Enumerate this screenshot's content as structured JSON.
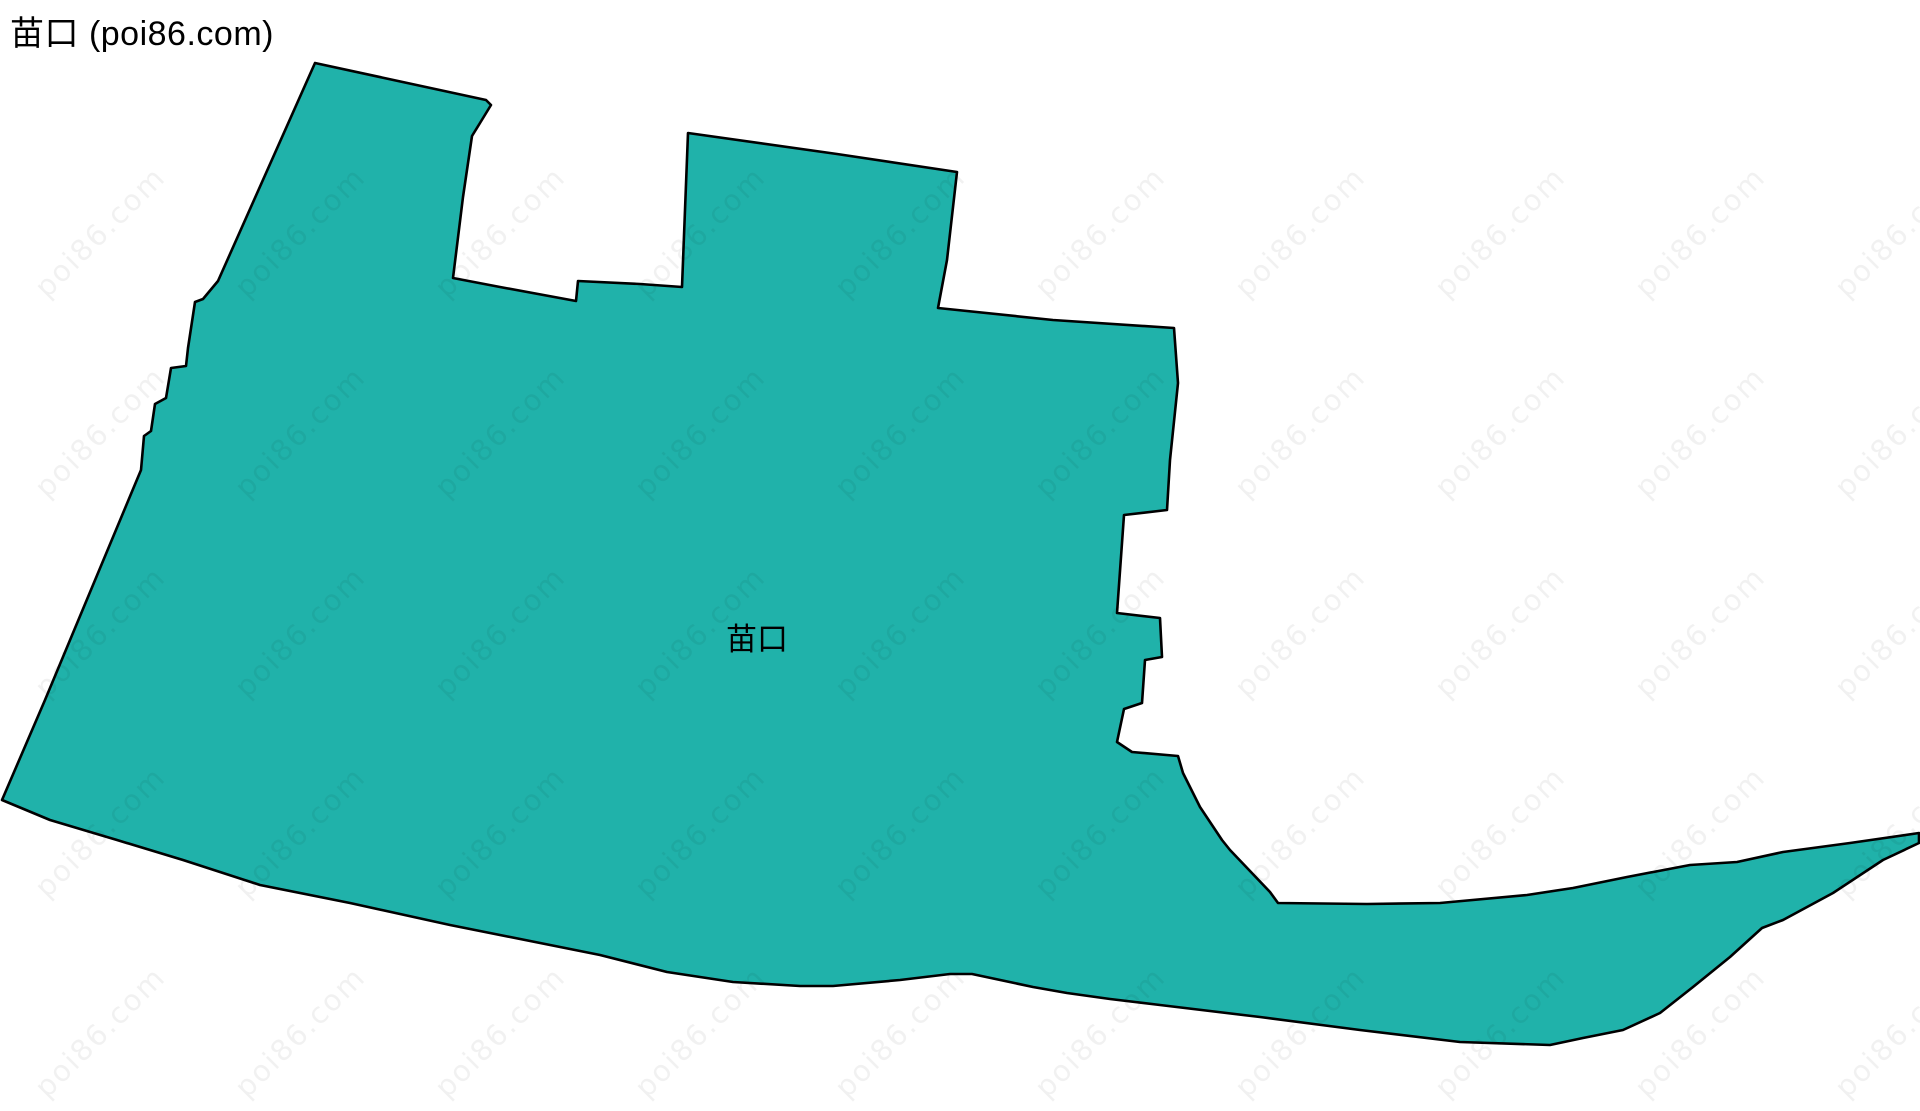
{
  "header": {
    "title": "苗口 (poi86.com)"
  },
  "map": {
    "region_name": "苗口",
    "label": "苗口",
    "label_position": {
      "x": 757,
      "y": 650
    },
    "viewbox": "0 0 1920 1111",
    "polygon_points": [
      [
        315,
        63
      ],
      [
        486,
        100
      ],
      [
        491,
        105
      ],
      [
        480,
        123
      ],
      [
        472,
        136
      ],
      [
        463,
        197
      ],
      [
        453,
        278
      ],
      [
        500,
        287
      ],
      [
        576,
        301
      ],
      [
        578,
        281
      ],
      [
        640,
        284
      ],
      [
        682,
        287
      ],
      [
        688,
        133
      ],
      [
        837,
        154
      ],
      [
        957,
        172
      ],
      [
        947,
        260
      ],
      [
        938,
        308
      ],
      [
        1053,
        320
      ],
      [
        1174,
        328
      ],
      [
        1178,
        383
      ],
      [
        1170,
        460
      ],
      [
        1167,
        510
      ],
      [
        1124,
        515
      ],
      [
        1117,
        613
      ],
      [
        1160,
        618
      ],
      [
        1162,
        657
      ],
      [
        1145,
        660
      ],
      [
        1142,
        703
      ],
      [
        1124,
        709
      ],
      [
        1117,
        742
      ],
      [
        1132,
        752
      ],
      [
        1178,
        756
      ],
      [
        1183,
        773
      ],
      [
        1200,
        807
      ],
      [
        1222,
        840
      ],
      [
        1230,
        850
      ],
      [
        1270,
        892
      ],
      [
        1278,
        903
      ],
      [
        1367,
        904
      ],
      [
        1440,
        903
      ],
      [
        1527,
        895
      ],
      [
        1573,
        888
      ],
      [
        1627,
        877
      ],
      [
        1690,
        865
      ],
      [
        1737,
        862
      ],
      [
        1783,
        852
      ],
      [
        1850,
        843
      ],
      [
        1919,
        833
      ],
      [
        1919,
        843
      ],
      [
        1883,
        860
      ],
      [
        1833,
        893
      ],
      [
        1783,
        920
      ],
      [
        1762,
        928
      ],
      [
        1730,
        957
      ],
      [
        1693,
        987
      ],
      [
        1660,
        1013
      ],
      [
        1623,
        1030
      ],
      [
        1583,
        1038
      ],
      [
        1550,
        1045
      ],
      [
        1460,
        1042
      ],
      [
        1360,
        1030
      ],
      [
        1260,
        1017
      ],
      [
        1160,
        1005
      ],
      [
        1110,
        999
      ],
      [
        1067,
        993
      ],
      [
        1033,
        987
      ],
      [
        972,
        974
      ],
      [
        950,
        974
      ],
      [
        900,
        980
      ],
      [
        833,
        986
      ],
      [
        800,
        986
      ],
      [
        733,
        982
      ],
      [
        667,
        972
      ],
      [
        600,
        955
      ],
      [
        450,
        925
      ],
      [
        350,
        903
      ],
      [
        260,
        885
      ],
      [
        183,
        860
      ],
      [
        117,
        840
      ],
      [
        50,
        820
      ],
      [
        2,
        800
      ],
      [
        45,
        700
      ],
      [
        141,
        470
      ],
      [
        144,
        436
      ],
      [
        151,
        431
      ],
      [
        155,
        404
      ],
      [
        166,
        398
      ],
      [
        171,
        368
      ],
      [
        186,
        366
      ],
      [
        188,
        348
      ],
      [
        195,
        302
      ],
      [
        203,
        299
      ],
      [
        218,
        281
      ]
    ]
  },
  "watermark": {
    "text": "poi86.com",
    "angle_deg": -45,
    "grid": {
      "start_x": 100,
      "start_y": 232,
      "step_x": 200,
      "step_y": 200,
      "cols": 10,
      "rows": 5
    }
  },
  "colors": {
    "background": "#ffffff",
    "region_fill": "#20b2aa",
    "region_stroke": "#000000",
    "title_color": "#000000",
    "label_color": "#000000",
    "watermark_color": "rgba(0,0,0,0.055)"
  }
}
